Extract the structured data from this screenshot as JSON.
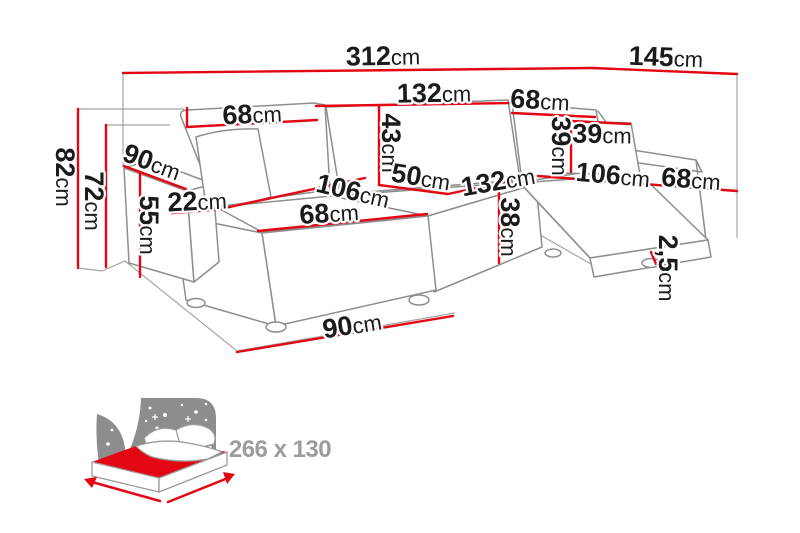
{
  "diagram_title": "U-shaped sofa dimension diagram",
  "unit_default": "cm",
  "dimensions": {
    "total_width": {
      "value": "312",
      "unit": "cm"
    },
    "right_depth": {
      "value": "145",
      "unit": "cm"
    },
    "back_left_width": {
      "value": "68",
      "unit": "cm"
    },
    "back_middle_width": {
      "value": "132",
      "unit": "cm"
    },
    "back_right_width": {
      "value": "68",
      "unit": "cm"
    },
    "backrest_height": {
      "value": "43",
      "unit": "cm"
    },
    "seat_depth_middle": {
      "value": "50",
      "unit": "cm"
    },
    "seat_middle_width": {
      "value": "132",
      "unit": "cm"
    },
    "chaise_left_depth": {
      "value": "106",
      "unit": "cm"
    },
    "chaise_left_seat_width": {
      "value": "68",
      "unit": "cm"
    },
    "armrest_width": {
      "value": "22",
      "unit": "cm"
    },
    "armrest_depth": {
      "value": "90",
      "unit": "cm"
    },
    "armrest_height": {
      "value": "55",
      "unit": "cm"
    },
    "total_height": {
      "value": "82",
      "unit": "cm"
    },
    "backrest_total_height": {
      "value": "72",
      "unit": "cm"
    },
    "seat_height": {
      "value": "38",
      "unit": "cm"
    },
    "pillow_height": {
      "value": "39",
      "unit": "cm"
    },
    "pillow_width": {
      "value": "39",
      "unit": "cm"
    },
    "chaise_right_depth": {
      "value": "106",
      "unit": "cm"
    },
    "chaise_right_arm_width": {
      "value": "68",
      "unit": "cm"
    },
    "leg_height": {
      "value": "2,5",
      "unit": "cm"
    },
    "chaise_left_width": {
      "value": "90",
      "unit": "cm"
    }
  },
  "sleeping_area": {
    "label": "266 x 130"
  },
  "icons": {
    "sleeping_function": "bed-with-starry-headboard-icon"
  },
  "colors": {
    "dimension_red": "#e30613",
    "outline_gray": "#8e8e8e",
    "guide_gray": "#a5a5a5",
    "label_color": "#1b1b1b",
    "icon_gray": "#8d8d8d",
    "sleeping_text_gray": "#9c9c9c"
  }
}
